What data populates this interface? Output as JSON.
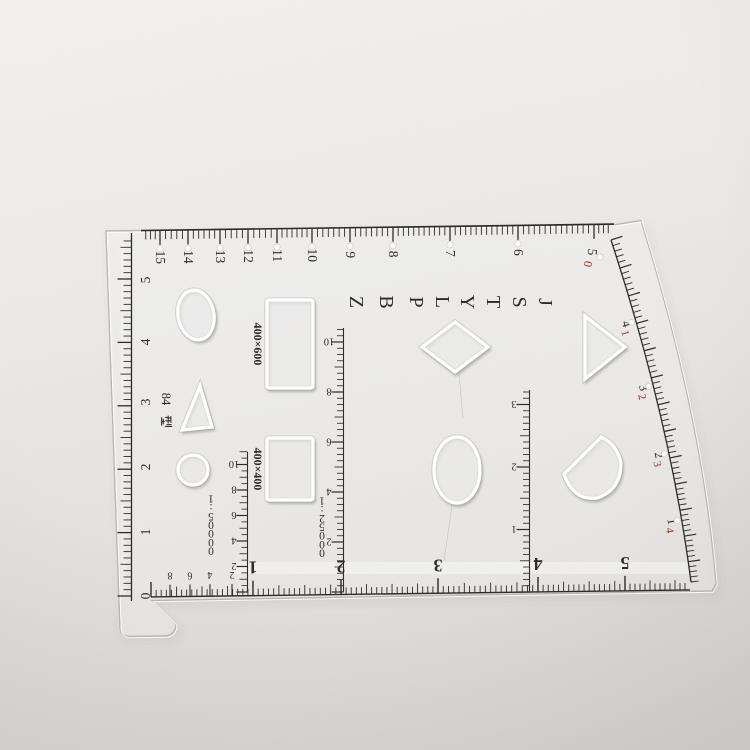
{
  "photo": {
    "description": "transparent plastic drafting template (map coordinate ruler) lying on textured paper",
    "paper_color": "#e9e7e4",
    "ink_color": "#2e2c29",
    "red_color": "#a52a1a"
  },
  "ruler": {
    "model": "84型",
    "top_scale": {
      "numbers": [
        "15",
        "14",
        "13",
        "12",
        "11",
        "10",
        "9",
        "8",
        "7",
        "6"
      ],
      "end_black": "5",
      "end_red": "0"
    },
    "left_scale": {
      "numbers": [
        "5",
        "4",
        "3",
        "2",
        "1",
        "0"
      ]
    },
    "code_letters": [
      "Z",
      "B",
      "P",
      "L",
      "Y",
      "T",
      "S",
      "J"
    ],
    "rect_label": "400×600",
    "square_label": "400×400",
    "map_scale_labels": {
      "fifty_k": "1:50000",
      "twentyfive_k": "1:25000"
    },
    "v_scale_50k_numbers": [
      "2",
      "4",
      "6",
      "8",
      "10"
    ],
    "v_scale_25k_numbers": [
      "2",
      "4",
      "6",
      "8",
      "10"
    ],
    "v_scale_right_numbers": [
      "1",
      "2",
      "3"
    ],
    "bottom_scale": {
      "minor_numbers": [
        "8",
        "6",
        "4",
        "2"
      ],
      "major_numbers": [
        "1",
        "2",
        "3",
        "4",
        "5"
      ]
    },
    "arc_scale": {
      "pairs": [
        {
          "black": "4",
          "red": "1"
        },
        {
          "black": "3",
          "red": "2"
        },
        {
          "black": "2",
          "red": "3"
        },
        {
          "black": "1",
          "red": "4"
        }
      ]
    }
  }
}
